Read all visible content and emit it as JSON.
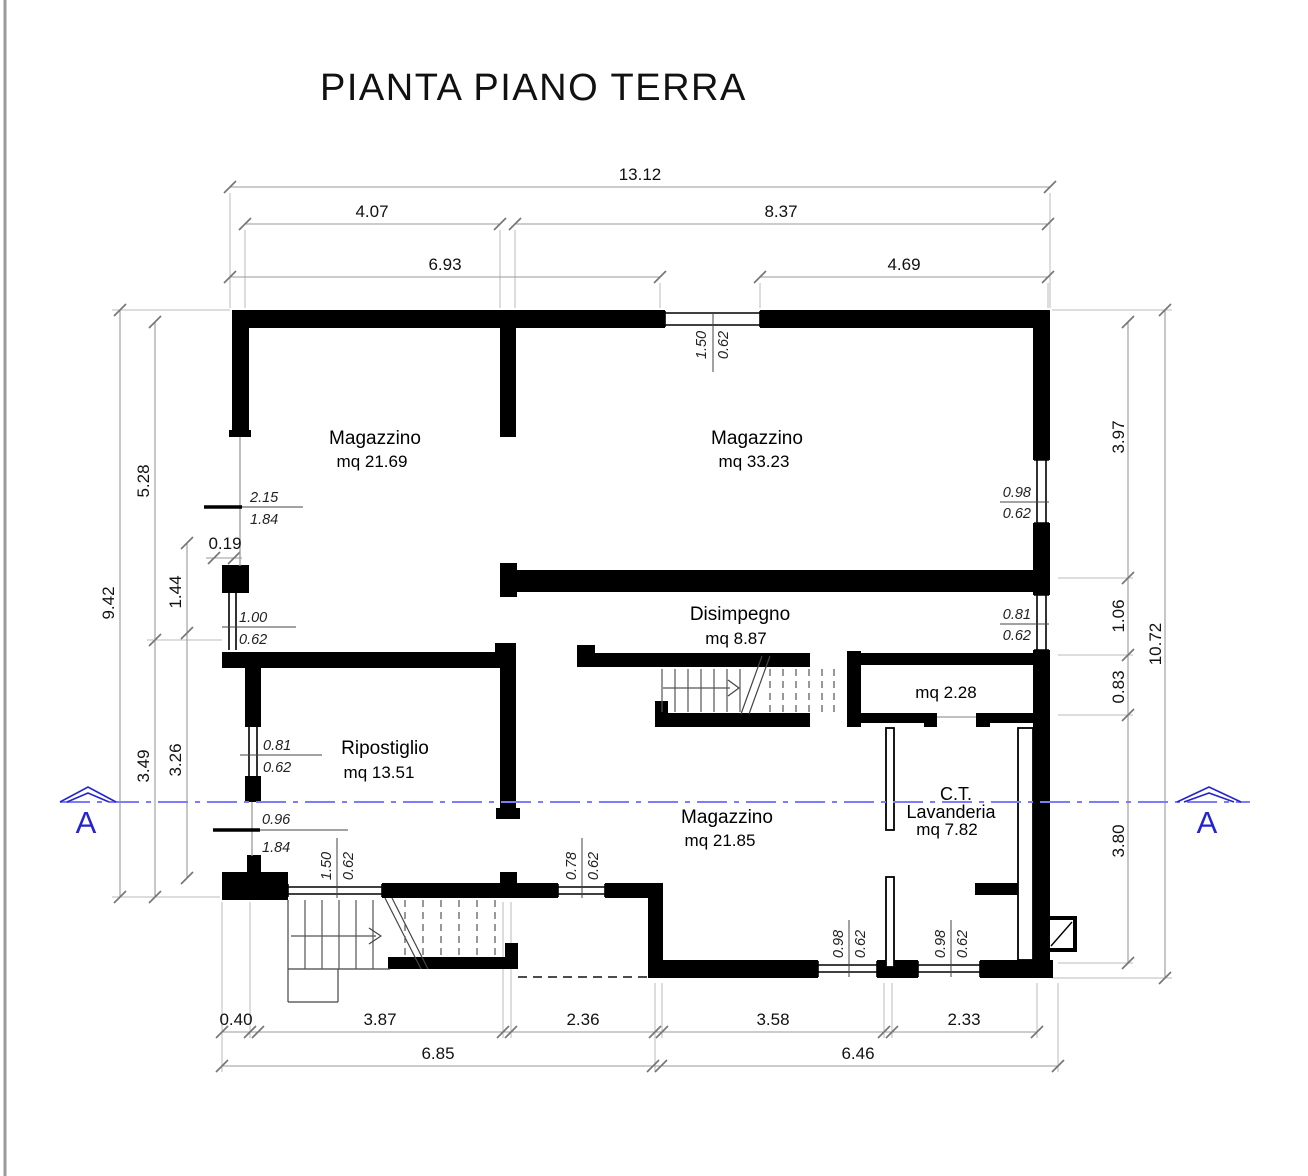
{
  "title": "PIANTA PIANO TERRA",
  "section": {
    "label": "A"
  },
  "rooms": [
    {
      "name": "Magazzino",
      "area": "mq 21.69"
    },
    {
      "name": "Magazzino",
      "area": "mq 33.23"
    },
    {
      "name": "Disimpegno",
      "area": "mq 8.87"
    },
    {
      "area": "mq 2.28"
    },
    {
      "name": "Ripostiglio",
      "area": "mq 13.51"
    },
    {
      "name": "Magazzino",
      "area": "mq 21.85"
    },
    {
      "name": "C.T.",
      "subname": "Lavanderia",
      "area": "mq 7.82"
    }
  ],
  "openings": [
    {
      "w": "1.50",
      "h": "0.62"
    },
    {
      "w": "0.98",
      "h": "0.62"
    },
    {
      "w": "0.81",
      "h": "0.62"
    },
    {
      "w": "2.15",
      "h": "1.84"
    },
    {
      "w": "1.00",
      "h": "0.62"
    },
    {
      "w": "0.81",
      "h": "0.62"
    },
    {
      "w": "0.96",
      "h": "1.84"
    },
    {
      "w": "1.50",
      "h": "0.62"
    },
    {
      "w": "0.78",
      "h": "0.62"
    },
    {
      "w": "0.98",
      "h": "0.62"
    },
    {
      "w": "0.98",
      "h": "0.62"
    }
  ],
  "dimensions": {
    "top": [
      "13.12",
      "4.07",
      "8.37",
      "6.93",
      "4.69"
    ],
    "bottom": [
      "0.40",
      "3.87",
      "2.36",
      "3.58",
      "2.33",
      "6.85",
      "6.46"
    ],
    "left": [
      "9.42",
      "5.28",
      "3.49",
      "1.44",
      "3.26",
      "0.19"
    ],
    "right": [
      "3.97",
      "1.06",
      "0.83",
      "3.80",
      "10.72"
    ]
  }
}
